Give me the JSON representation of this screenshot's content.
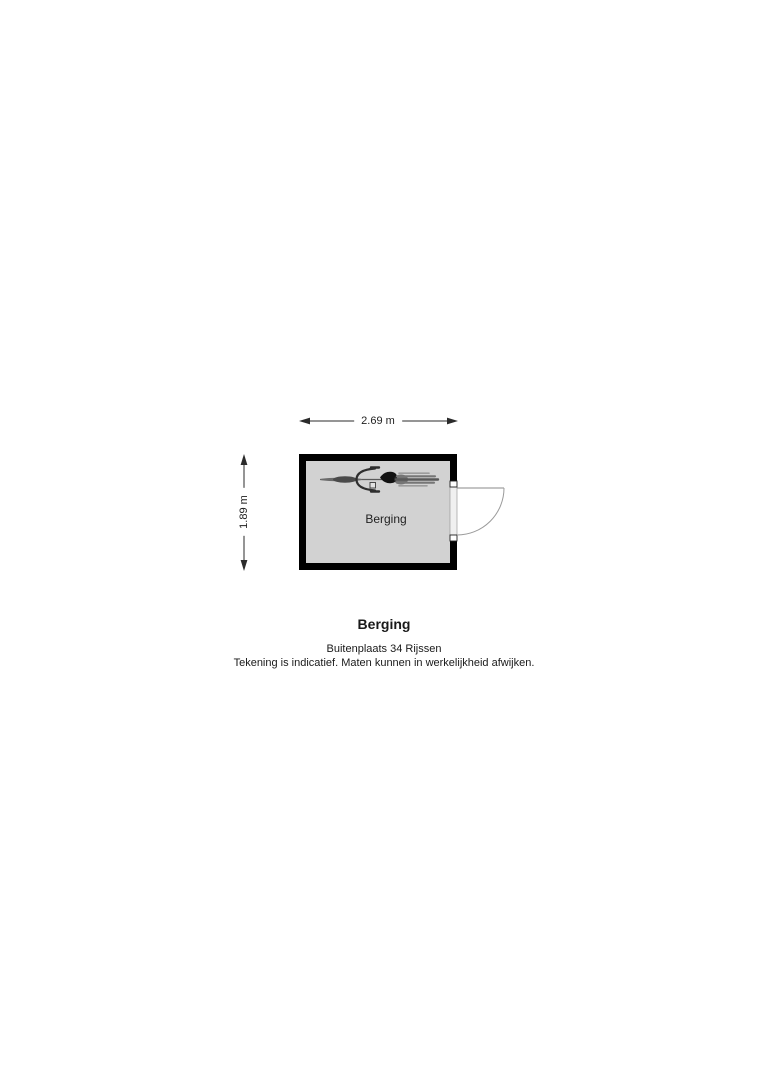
{
  "page": {
    "background_color": "#ffffff"
  },
  "floorplan": {
    "room": {
      "label": "Berging",
      "floor_color": "#d2d2d2",
      "wall_color": "#000000"
    },
    "dimensions": {
      "width": "2.69 m",
      "height": "1.89 m"
    },
    "icons": {
      "bicycle": "bicycle-icon",
      "door": "door-swing-icon"
    }
  },
  "footer": {
    "title": "Berging",
    "address": "Buitenplaats 34 Rijssen",
    "disclaimer": "Tekening is indicatief. Maten kunnen in werkelijkheid afwijken."
  }
}
